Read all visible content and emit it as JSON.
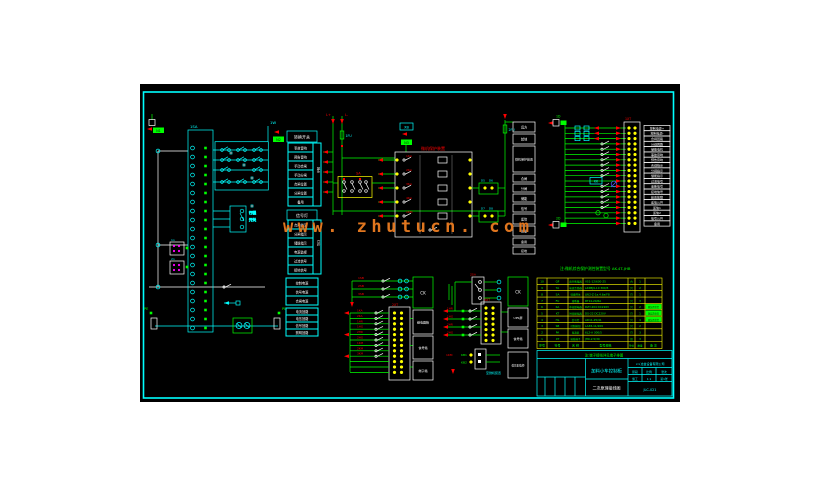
{
  "watermark": "www. zhutucn. com",
  "note": "注:微机综合保护测控装置型号 AK-4T-JHB",
  "connectors": {
    "top_left": "N1",
    "mid": "N2",
    "xb": "XB",
    "relay_top": "N3",
    "right_top": "1D",
    "right_bottom": "2D",
    "pe_left": "PE",
    "pe_right": "PE"
  },
  "left": {
    "block_label": "1SA",
    "wire_label": "1W",
    "limit_switch": [
      "行程",
      "开关"
    ],
    "xt1": "1n",
    "xt2": "2n",
    "tableA": {
      "header": "转换开关",
      "side": "触点",
      "rows": [
        "事故音响",
        "预告音响",
        "手动合闸",
        "手动分闸",
        "合闸位置",
        "分闸位置",
        "备用"
      ]
    },
    "tableB": {
      "header": "信号灯",
      "side": "灯位",
      "rows": [
        "合闸指示",
        "分闸指示",
        "储能指示",
        "电源监视",
        "过流信号",
        "接地信号"
      ]
    },
    "tableC": {
      "rows": [
        "控制电源",
        "信号电源",
        "合闸电源"
      ]
    },
    "tableD": {
      "rows": [
        "电流回路",
        "电压回路",
        "信号回路",
        "照明回路"
      ]
    }
  },
  "middle": {
    "bus_plus": "L+",
    "bus_minus": "L-",
    "fuse1": "1FU",
    "fuse2": "2FU",
    "sa_label": "SA",
    "relay_title": "微机保护装置",
    "relay_rows": [
      "1KA",
      "2KA",
      "3KA",
      "4KA",
      "1KM"
    ],
    "term_labels": [
      "D5",
      "D6",
      "D7",
      "D8"
    ],
    "device_cells": [
      "远方",
      "就地",
      "微机保护装置",
      "合闸",
      "分闸",
      "储能",
      "信号",
      "遥信",
      "测量",
      "备用",
      "接地"
    ]
  },
  "right": {
    "strip_title": "1XT",
    "kk": "KK",
    "labels": [
      "控制电源+",
      "控制电源-",
      "合闸回路",
      "分闸回路",
      "储能电机",
      "事故音响",
      "预告音响",
      "合闸指示",
      "分闸指示",
      "储能指示",
      "过流信号",
      "速断信号",
      "接地信号",
      "装置故障",
      "遥信公共",
      "遥信1",
      "遥信2",
      "信号公共",
      "备用"
    ]
  },
  "g1": {
    "top_labels": [
      "1SB",
      "2SB",
      "3SB"
    ],
    "ck": "CK",
    "xt": "2XT",
    "row_labels": [
      "1KA",
      "2KA",
      "1HR",
      "1HG",
      "2HR",
      "2HG",
      "1KM",
      "2KM",
      "3KM"
    ],
    "boxes": [
      "继电器箱",
      "信号箱",
      "端子箱"
    ]
  },
  "g2": {
    "sa": "2SA",
    "ck": "CK",
    "xt": "3XT",
    "row_labels": [
      "1HR",
      "1HG",
      "2HR",
      "2HG"
    ],
    "boxes": [
      "UPS屏",
      "信号箱",
      "低压配电柜"
    ]
  },
  "g3": {
    "km": "1KM",
    "k1": "KB1",
    "k2": "KB2",
    "dest": "至微机装置"
  },
  "bom": {
    "headers": [
      "序号",
      "符号",
      "名 称",
      "型号规格",
      "单位",
      "数量",
      "备 注"
    ],
    "rows": [
      [
        "10",
        "QF",
        "真空断路器",
        "VS1-12/630-25",
        "台",
        "1",
        ""
      ],
      [
        "9",
        "TA",
        "电流互感器",
        "LZZBJ9-10 300/5",
        "只",
        "2",
        ""
      ],
      [
        "8",
        "SA",
        "转换开关",
        "LW2-Z-1a.4.6a/F8",
        "只",
        "1",
        ""
      ],
      [
        "7",
        "FU",
        "熔断器",
        "RT14-20/6A",
        "只",
        "3",
        ""
      ],
      [
        "6",
        "KA",
        "中间继电器",
        "DZY-204 DC220V",
        "只",
        "2",
        "随装置供货"
      ],
      [
        "5",
        "KT",
        "时间继电器",
        "DS-22 DC220V",
        "只",
        "1",
        "随装置供货"
      ],
      [
        "4",
        "HL",
        "信号灯",
        "AD11-25/41",
        "只",
        "4",
        "随装置供货"
      ],
      [
        "3",
        "SB",
        "控制按钮",
        "LA38-11/209",
        "只",
        "2",
        ""
      ],
      [
        "2",
        "PA",
        "电流表",
        "6L2-A 300/5",
        "只",
        "3",
        ""
      ],
      [
        "1",
        "XT",
        "接线端子",
        "JH9-2.5/30",
        "组",
        "3",
        ""
      ]
    ]
  },
  "title_block": {
    "note": "注:端子接线详见端子排图",
    "product": "加料小车控制柜",
    "drawing": "二次原理接线图",
    "company": "××冶金设备有限公司",
    "grid": {
      "r1": [
        "阶段",
        "比例",
        "张次"
      ],
      "r2": [
        "施工",
        "1:1",
        "第1张"
      ]
    },
    "dwg_no": "JLC-021"
  }
}
